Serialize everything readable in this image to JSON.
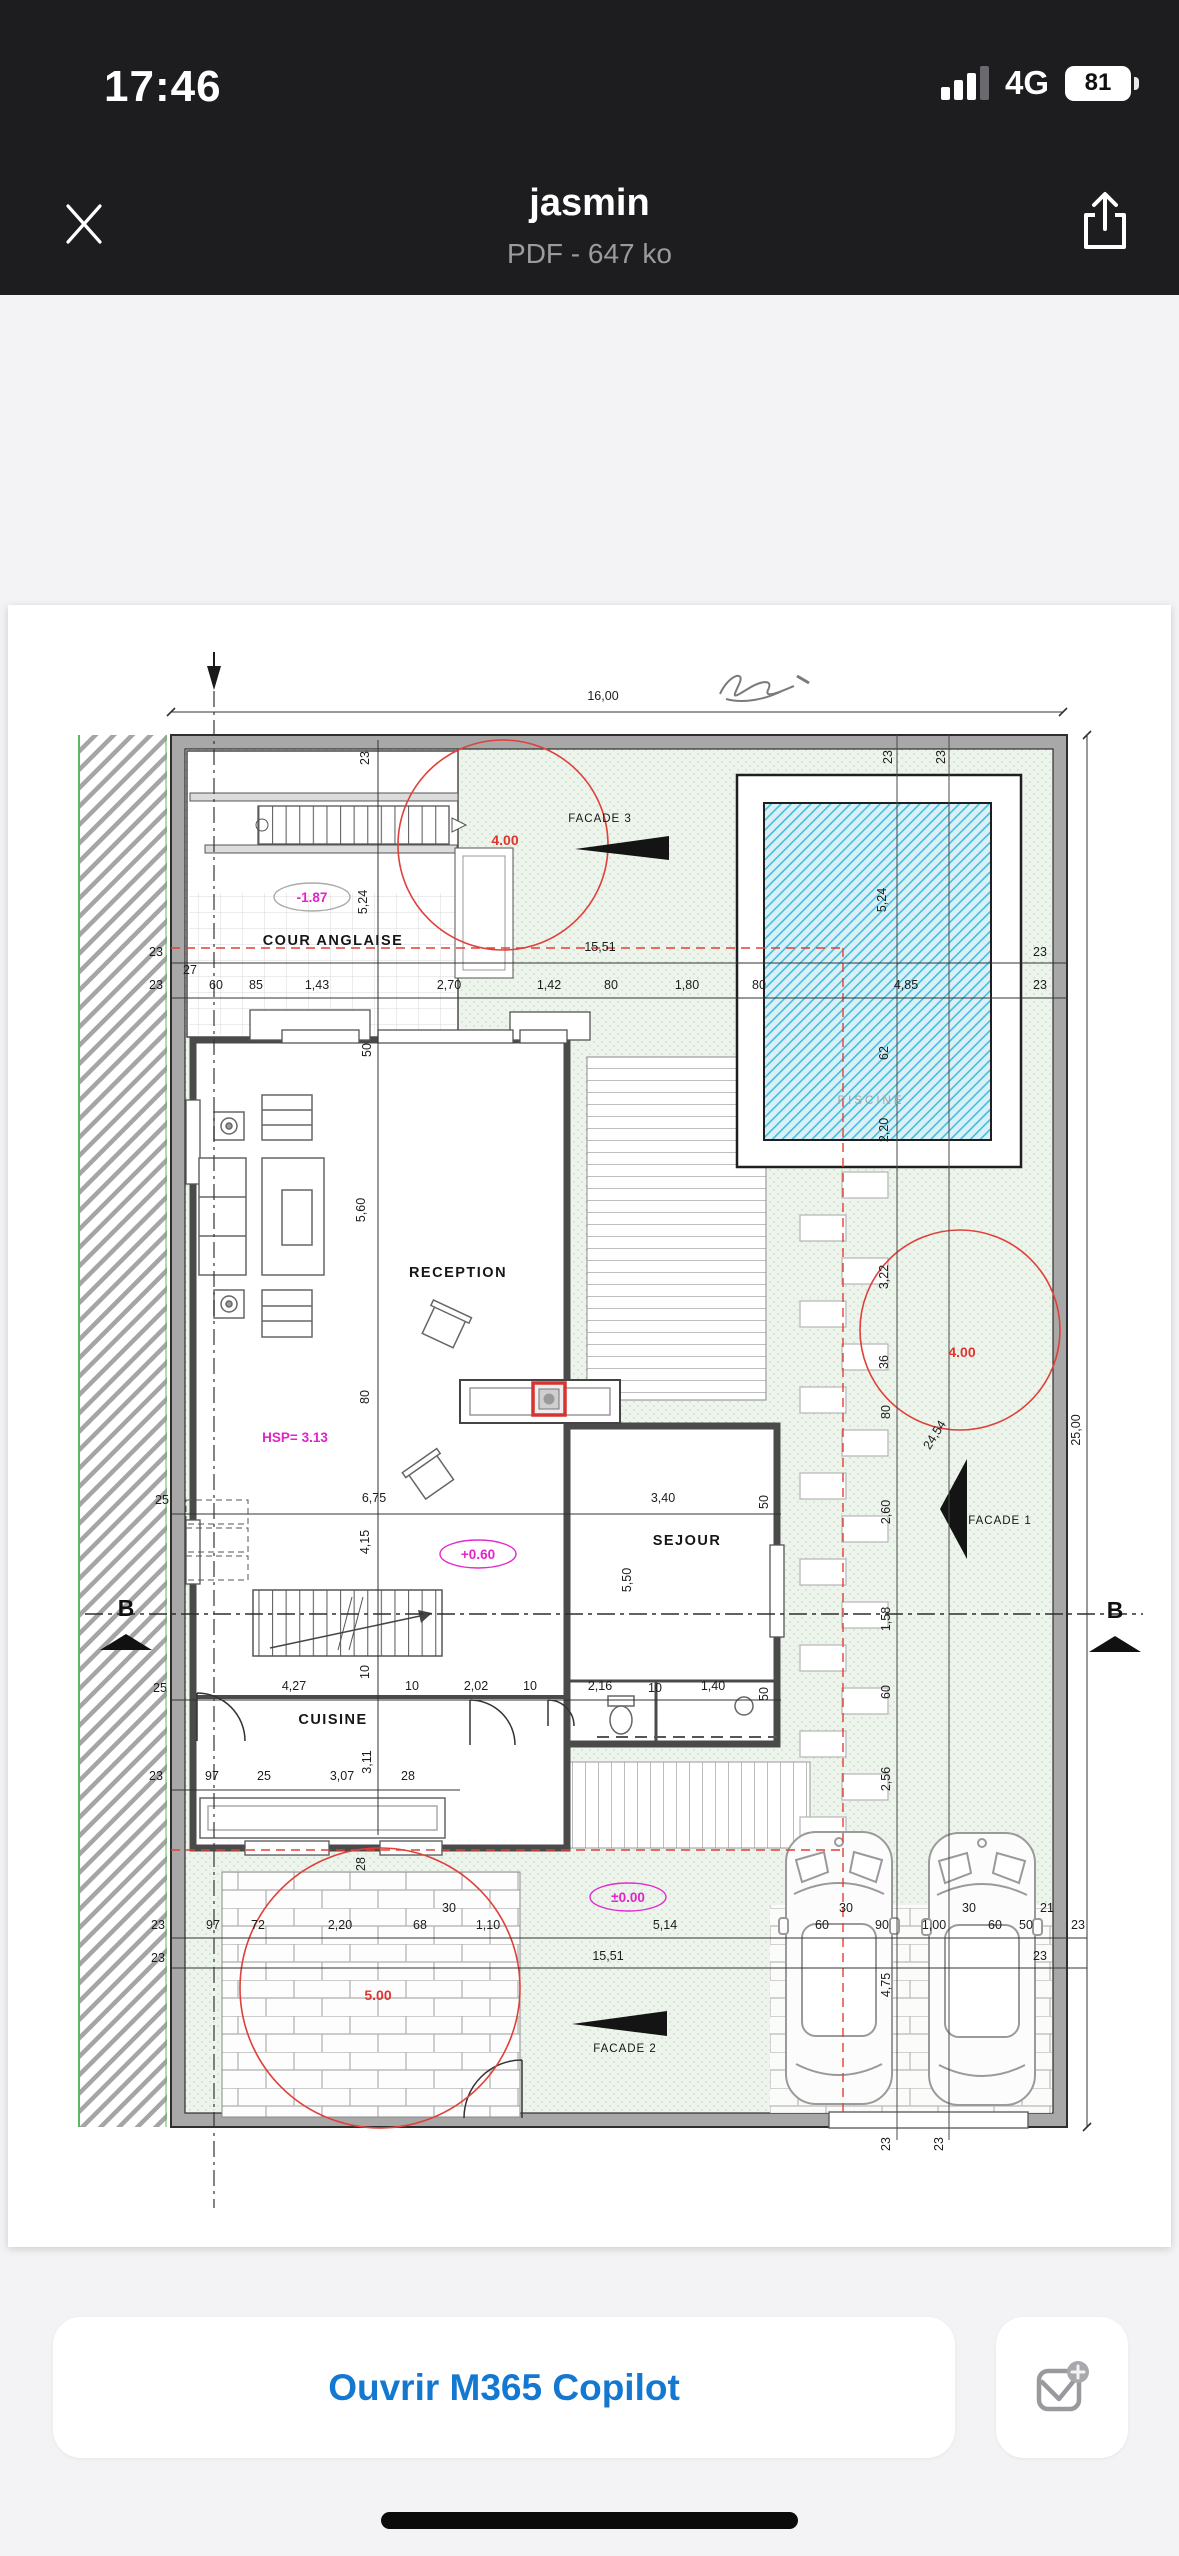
{
  "status_bar": {
    "time": "17:46",
    "network": "4G",
    "battery": "81"
  },
  "header": {
    "title": "jasmin",
    "subtitle": "PDF - 647 ko"
  },
  "footer": {
    "open_button_label": "Ouvrir M365 Copilot"
  },
  "colors": {
    "accent_blue": "#1478d1",
    "annotation_red": "#e0352f",
    "annotation_magenta": "#e322c9",
    "pool_blue": "#43bedb",
    "garden_green": "#edf4ec"
  },
  "plan": {
    "rooms": [
      "COUR ANGLAISE",
      "RECEPTION",
      "SEJOUR",
      "CUISINE",
      "PISCINE"
    ],
    "facades": [
      "FACADE 1",
      "FACADE 2",
      "FACADE 3"
    ],
    "levels": [
      "-1.87",
      "+0.60",
      "±0.00",
      "HSP= 3.13",
      "4.00",
      "5.00"
    ],
    "labels": [
      {
        "t": "16,00",
        "x": 603,
        "y": 700,
        "c": "d"
      },
      {
        "t": "23",
        "x": 369,
        "y": 758,
        "r": -90,
        "c": "d"
      },
      {
        "t": "23",
        "x": 892,
        "y": 757,
        "r": -90,
        "c": "d"
      },
      {
        "t": "23",
        "x": 945,
        "y": 757,
        "r": -90,
        "c": "d"
      },
      {
        "t": "5,24",
        "x": 367,
        "y": 902,
        "r": -90,
        "c": "d"
      },
      {
        "t": "5,24",
        "x": 886,
        "y": 900,
        "r": -90,
        "c": "d"
      },
      {
        "t": "4.00",
        "x": 505,
        "y": 845,
        "c": "red"
      },
      {
        "t": "-1.87",
        "x": 312,
        "y": 902,
        "c": "mag",
        "e": "#aaaaaa"
      },
      {
        "t": "COUR ANGLAISE",
        "x": 333,
        "y": 945,
        "c": "room"
      },
      {
        "t": "FACADE 3",
        "x": 600,
        "y": 822,
        "c": "fac"
      },
      {
        "t": "15,51",
        "x": 600,
        "y": 951,
        "c": "d"
      },
      {
        "t": "23",
        "x": 156,
        "y": 956,
        "c": "d"
      },
      {
        "t": "23",
        "x": 1040,
        "y": 956,
        "c": "d"
      },
      {
        "t": "27",
        "x": 190,
        "y": 974,
        "c": "d"
      },
      {
        "t": "23",
        "x": 156,
        "y": 989,
        "c": "d"
      },
      {
        "t": "60",
        "x": 216,
        "y": 989,
        "c": "d"
      },
      {
        "t": "85",
        "x": 256,
        "y": 989,
        "c": "d"
      },
      {
        "t": "1,43",
        "x": 317,
        "y": 989,
        "c": "d"
      },
      {
        "t": "2,70",
        "x": 449,
        "y": 989,
        "c": "d"
      },
      {
        "t": "1,42",
        "x": 549,
        "y": 989,
        "c": "d"
      },
      {
        "t": "80",
        "x": 611,
        "y": 989,
        "c": "d"
      },
      {
        "t": "1,80",
        "x": 687,
        "y": 989,
        "c": "d"
      },
      {
        "t": "80",
        "x": 759,
        "y": 989,
        "c": "d"
      },
      {
        "t": "4,85",
        "x": 906,
        "y": 989,
        "c": "d"
      },
      {
        "t": "23",
        "x": 1040,
        "y": 989,
        "c": "d"
      },
      {
        "t": "50",
        "x": 371,
        "y": 1050,
        "r": -90,
        "c": "d"
      },
      {
        "t": "62",
        "x": 888,
        "y": 1053,
        "r": -90,
        "c": "d"
      },
      {
        "t": "PISCINE",
        "x": 871,
        "y": 1104,
        "c": "gray"
      },
      {
        "t": "2,20",
        "x": 888,
        "y": 1130,
        "r": -90,
        "c": "d"
      },
      {
        "t": "5,60",
        "x": 365,
        "y": 1210,
        "r": -90,
        "c": "d"
      },
      {
        "t": "RECEPTION",
        "x": 458,
        "y": 1277,
        "c": "room"
      },
      {
        "t": "3,22",
        "x": 888,
        "y": 1277,
        "r": -90,
        "c": "d"
      },
      {
        "t": "4.00",
        "x": 962,
        "y": 1357,
        "c": "red"
      },
      {
        "t": "36",
        "x": 888,
        "y": 1362,
        "r": -90,
        "c": "d"
      },
      {
        "t": "80",
        "x": 369,
        "y": 1397,
        "r": -90,
        "c": "d"
      },
      {
        "t": "80",
        "x": 890,
        "y": 1412,
        "r": -90,
        "c": "d"
      },
      {
        "t": "24,54",
        "x": 938,
        "y": 1437,
        "r": -58,
        "c": "d"
      },
      {
        "t": "25,00",
        "x": 1080,
        "y": 1430,
        "r": -90,
        "c": "d"
      },
      {
        "t": "HSP= 3.13",
        "x": 295,
        "y": 1442,
        "c": "mag"
      },
      {
        "t": "2,60",
        "x": 890,
        "y": 1512,
        "r": -90,
        "c": "d"
      },
      {
        "t": "FACADE 1",
        "x": 1000,
        "y": 1524,
        "c": "fac"
      },
      {
        "t": "25",
        "x": 162,
        "y": 1504,
        "c": "d"
      },
      {
        "t": "6,75",
        "x": 374,
        "y": 1502,
        "c": "d"
      },
      {
        "t": "3,40",
        "x": 663,
        "y": 1502,
        "c": "d"
      },
      {
        "t": "50",
        "x": 768,
        "y": 1502,
        "r": -90,
        "c": "d"
      },
      {
        "t": "4,15",
        "x": 369,
        "y": 1542,
        "r": -90,
        "c": "d"
      },
      {
        "t": "+0.60",
        "x": 478,
        "y": 1559,
        "c": "mag",
        "e": "#e32bd0"
      },
      {
        "t": "SEJOUR",
        "x": 687,
        "y": 1545,
        "c": "room"
      },
      {
        "t": "5,50",
        "x": 631,
        "y": 1580,
        "r": -90,
        "c": "d"
      },
      {
        "t": "1,58",
        "x": 890,
        "y": 1619,
        "r": -90,
        "c": "d"
      },
      {
        "t": "B",
        "x": 126,
        "y": 1616,
        "c": "B"
      },
      {
        "t": "B",
        "x": 1115,
        "y": 1618,
        "c": "B"
      },
      {
        "t": "25",
        "x": 160,
        "y": 1692,
        "c": "d"
      },
      {
        "t": "4,27",
        "x": 294,
        "y": 1690,
        "c": "d"
      },
      {
        "t": "10",
        "x": 369,
        "y": 1672,
        "r": -90,
        "c": "d"
      },
      {
        "t": "10",
        "x": 412,
        "y": 1690,
        "c": "d"
      },
      {
        "t": "2,02",
        "x": 476,
        "y": 1690,
        "c": "d"
      },
      {
        "t": "10",
        "x": 530,
        "y": 1690,
        "c": "d"
      },
      {
        "t": "2,16",
        "x": 600,
        "y": 1690,
        "c": "d"
      },
      {
        "t": "10",
        "x": 655,
        "y": 1692,
        "c": "d"
      },
      {
        "t": "1,40",
        "x": 713,
        "y": 1690,
        "c": "d"
      },
      {
        "t": "50",
        "x": 768,
        "y": 1694,
        "r": -90,
        "c": "d"
      },
      {
        "t": "CUISINE",
        "x": 333,
        "y": 1724,
        "c": "room"
      },
      {
        "t": "60",
        "x": 890,
        "y": 1692,
        "r": -90,
        "c": "d"
      },
      {
        "t": "3,11",
        "x": 371,
        "y": 1762,
        "r": -90,
        "c": "d"
      },
      {
        "t": "23",
        "x": 156,
        "y": 1780,
        "c": "d"
      },
      {
        "t": "97",
        "x": 212,
        "y": 1780,
        "c": "d"
      },
      {
        "t": "25",
        "x": 264,
        "y": 1780,
        "c": "d"
      },
      {
        "t": "3,07",
        "x": 342,
        "y": 1780,
        "c": "d"
      },
      {
        "t": "28",
        "x": 408,
        "y": 1780,
        "c": "d"
      },
      {
        "t": "2,56",
        "x": 890,
        "y": 1779,
        "r": -90,
        "c": "d"
      },
      {
        "t": "28",
        "x": 365,
        "y": 1864,
        "r": -90,
        "c": "d"
      },
      {
        "t": "±0.00",
        "x": 628,
        "y": 1902,
        "c": "mag",
        "e": "#e32bd0"
      },
      {
        "t": "30",
        "x": 449,
        "y": 1912,
        "c": "d"
      },
      {
        "t": "30",
        "x": 846,
        "y": 1912,
        "c": "d"
      },
      {
        "t": "30",
        "x": 969,
        "y": 1912,
        "c": "d"
      },
      {
        "t": "21",
        "x": 1047,
        "y": 1912,
        "c": "d"
      },
      {
        "t": "23",
        "x": 158,
        "y": 1929,
        "c": "d"
      },
      {
        "t": "97",
        "x": 213,
        "y": 1929,
        "c": "d"
      },
      {
        "t": "72",
        "x": 258,
        "y": 1929,
        "c": "d"
      },
      {
        "t": "2,20",
        "x": 340,
        "y": 1929,
        "c": "d"
      },
      {
        "t": "68",
        "x": 420,
        "y": 1929,
        "c": "d"
      },
      {
        "t": "1,10",
        "x": 488,
        "y": 1929,
        "c": "d"
      },
      {
        "t": "5,14",
        "x": 665,
        "y": 1929,
        "c": "d"
      },
      {
        "t": "60",
        "x": 822,
        "y": 1929,
        "c": "d"
      },
      {
        "t": "90",
        "x": 882,
        "y": 1929,
        "c": "d"
      },
      {
        "t": "1,00",
        "x": 934,
        "y": 1929,
        "c": "d"
      },
      {
        "t": "60",
        "x": 995,
        "y": 1929,
        "c": "d"
      },
      {
        "t": "50",
        "x": 1026,
        "y": 1929,
        "c": "d"
      },
      {
        "t": "23",
        "x": 1078,
        "y": 1929,
        "c": "d"
      },
      {
        "t": "23",
        "x": 158,
        "y": 1962,
        "c": "d"
      },
      {
        "t": "15,51",
        "x": 608,
        "y": 1960,
        "c": "d"
      },
      {
        "t": "23",
        "x": 1040,
        "y": 1960,
        "c": "d"
      },
      {
        "t": "5.00",
        "x": 378,
        "y": 2000,
        "c": "red"
      },
      {
        "t": "4,75",
        "x": 890,
        "y": 1985,
        "r": -90,
        "c": "d"
      },
      {
        "t": "FACADE 2",
        "x": 625,
        "y": 2052,
        "c": "fac"
      },
      {
        "t": "23",
        "x": 890,
        "y": 2144,
        "r": -90,
        "c": "d"
      },
      {
        "t": "23",
        "x": 943,
        "y": 2144,
        "r": -90,
        "c": "d"
      }
    ]
  }
}
